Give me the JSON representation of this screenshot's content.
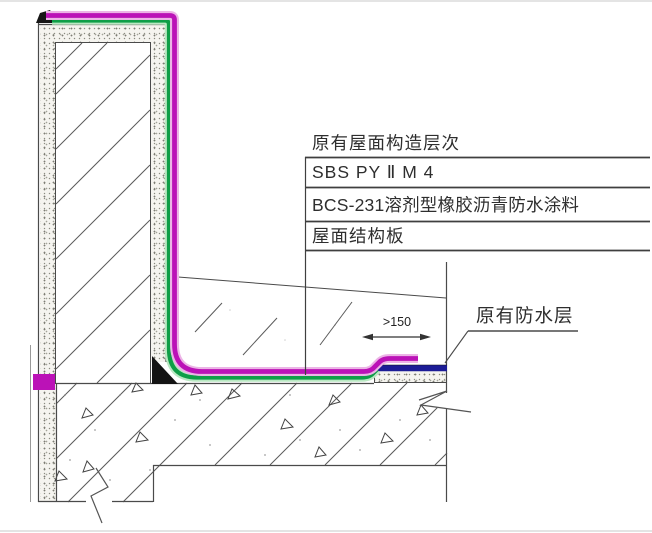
{
  "drawing": {
    "layer_callout": {
      "title": "原有屋面构造层次",
      "rows": [
        "SBS PY Ⅱ M 4",
        "BCS-231溶剂型橡胶沥青防水涂料",
        "屋面结构板"
      ]
    },
    "labels": {
      "existing_waterproof_layer": "原有防水层",
      "lap_dimension": ">150"
    },
    "colors": {
      "new_membrane_magenta": "#bb12b7",
      "new_coating_green": "#0e9e47",
      "existing_waterproof_blue": "#1c1c96",
      "line_dark": "#4a4a4a"
    }
  }
}
